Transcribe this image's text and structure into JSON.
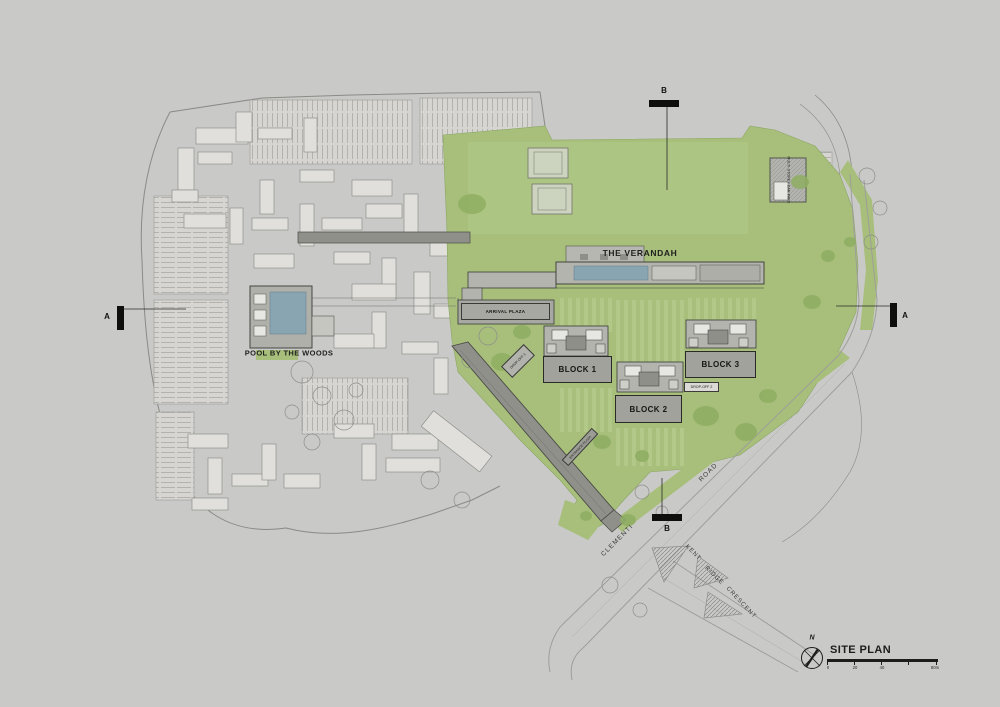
{
  "plan": {
    "buildings": {
      "verandah_label": "THE VERANDAH",
      "block1_label": "BLOCK 1",
      "block2_label": "BLOCK 2",
      "block3_label": "BLOCK 3",
      "pool_label": "POOL BY THE WOODS",
      "arrival_plaza_label": "ARRIVAL PLAZA",
      "drop_off_1_label": "DROP-OFF 1",
      "drop_off_2_label": "DROP-OFF 2",
      "entrance_plaza_label": "ENTRANCE PLAZA",
      "carpark_label": "MULTI-STOREY CAR PARK"
    },
    "roads": {
      "clementi": "CLEMENTI",
      "road": "ROAD",
      "kent": "KENT",
      "ridge": "RIDGE",
      "crescent": "CRESCENT"
    },
    "section_markers": {
      "a_left": "A",
      "a_right": "A",
      "b_top": "B",
      "b_bottom": "B"
    }
  },
  "title_block": {
    "north": "N",
    "title": "SITE PLAN",
    "scale_ticks": [
      "0",
      "20",
      "40",
      "80m"
    ]
  },
  "colors": {
    "background": "#c9c9c7",
    "landscape_green": "#a7bf7b",
    "field_green": "#aec584",
    "tree_green": "#8fae62",
    "building_gray": "#b4b4af",
    "context_fill": "#e0dfdc",
    "pool_blue": "#8aa5b2",
    "path_gray": "#90908b",
    "line_dark": "#3a3a37"
  }
}
